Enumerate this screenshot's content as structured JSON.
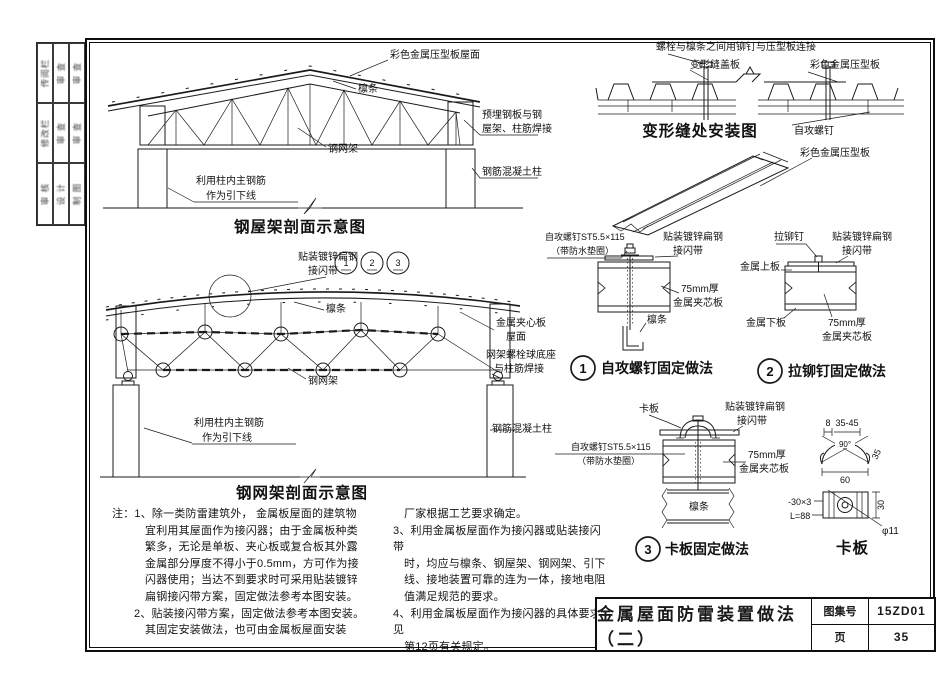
{
  "page": {
    "bg": "#ffffff",
    "ink": "#1a1a1a"
  },
  "binding_strip": {
    "rows": [
      [
        "传阅栏",
        "审 查",
        "审 查"
      ],
      [
        "修改栏",
        "审 查",
        "审 查"
      ],
      [
        "审 核",
        "设 计",
        "制 图"
      ]
    ]
  },
  "truss_section": {
    "caption": "钢屋架剖面示意图",
    "labels": {
      "roof": "彩色金属压型板屋面",
      "purlin": "檩条",
      "grid": "钢网架",
      "embed1": "预埋钢板与钢",
      "embed2": "屋架、柱筋焊接",
      "column": "钢筋混凝土柱",
      "rebar1": "利用柱内主钢筋",
      "rebar2": "作为引下线"
    }
  },
  "grid_section": {
    "caption": "钢网架剖面示意图",
    "callouts": [
      "1",
      "2",
      "3"
    ],
    "labels": {
      "strip1": "贴装镀锌扁钢",
      "strip2": "接闪带",
      "purlin": "檩条",
      "sandwich1": "金属夹心板",
      "sandwich2": "屋面",
      "ballbase1": "网架螺栓球底座",
      "ballbase2": "与柱筋焊接",
      "grid": "钢网架",
      "rebar1": "利用柱内主钢筋",
      "rebar2": "作为引下线",
      "column": "钢筋混凝土柱"
    }
  },
  "joint_install": {
    "caption": "变形缝处安装图",
    "labels": {
      "bolt_note": "螺栓与檩条之间用铆钉与压型板连接",
      "cover": "变形缝盖板",
      "sheet": "彩色金属压型板",
      "screw": "自攻螺钉"
    }
  },
  "sheet3d": {
    "label": "彩色金属压型板"
  },
  "detail1": {
    "number": "1",
    "caption": "自攻螺钉固定做法",
    "labels": {
      "screw1": "自攻螺钉ST5.5×115",
      "screw2": "（带防水垫圈）",
      "strip1": "贴装镀锌扁钢",
      "strip2": "接闪带",
      "panel1": "75mm厚",
      "panel2": "金属夹芯板",
      "purlin": "檩条"
    }
  },
  "detail2": {
    "number": "2",
    "caption": "拉铆钉固定做法",
    "labels": {
      "rivet": "拉铆钉",
      "strip1": "贴装镀锌扁钢",
      "strip2": "接闪带",
      "top_plate": "金属上板",
      "bottom_plate": "金属下板",
      "panel1": "75mm厚",
      "panel2": "金属夹芯板"
    }
  },
  "detail3": {
    "number": "3",
    "caption": "卡板固定做法",
    "labels": {
      "clamp": "卡板",
      "strip1": "贴装镀锌扁钢",
      "strip2": "接闪带",
      "screw1": "自攻螺钉ST5.5×115",
      "screw2": "（带防水垫圈）",
      "panel1": "75mm厚",
      "panel2": "金属夹芯板",
      "purlin": "檩条"
    }
  },
  "clamp_detail": {
    "caption": "卡板",
    "dims": {
      "w8": "8",
      "range": "35-45",
      "angle": "90°",
      "w60": "60",
      "side": "35",
      "plate": "-30×3",
      "length": "L=88",
      "hole": "φ11",
      "h30": "30"
    }
  },
  "notes": {
    "col1": [
      "注：1、除一类防雷建筑外， 金属板屋面的建筑物",
      "宜利用其屋面作为接闪器；由于金属板种类",
      "繁多，无论是单板、夹心板或复合板其外露",
      "金属部分厚度不得小于0.5mm，方可作为接",
      "闪器使用；当达不到要求时可采用贴装镀锌",
      "扁钢接闪带方案，固定做法参考本图安装。",
      "2、贴装接闪带方案，固定做法参考本图安装。",
      "其固定安装做法，也可由金属板屋面安装"
    ],
    "col2": [
      "厂家根据工艺要求确定。",
      "3、利用金属板屋面作为接闪器或贴装接闪带",
      "时，均应与檩条、钢屋架、钢网架、引下",
      "线、接地装置可靠的连为一体，接地电阻",
      "值满足规范的要求。",
      "4、利用金属板屋面作为接闪器的具体要求见",
      "第12页有关规定。"
    ]
  },
  "titlebar": {
    "title": "金属屋面防雷装置做法（二）",
    "atlas_label": "图集号",
    "atlas_no": "15ZD01",
    "page_label": "页",
    "page_no": "35"
  }
}
